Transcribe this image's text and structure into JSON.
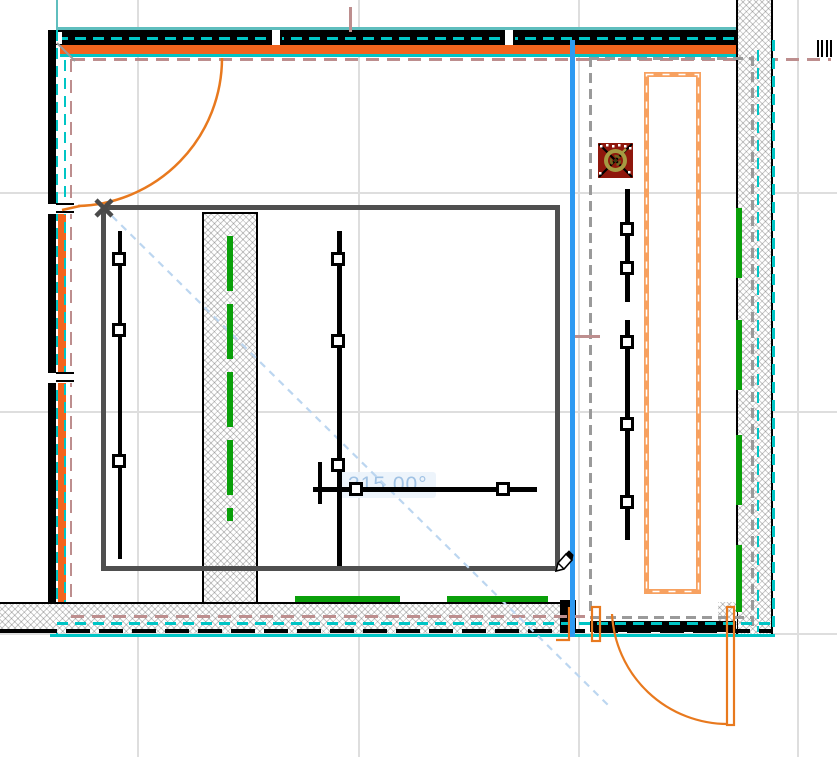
{
  "app": {
    "type": "cad-floor-plan-canvas",
    "tool": "pencil-draw"
  },
  "tooltip": {
    "text": "315.00°"
  },
  "colors": {
    "wall_orange": "#f3641d",
    "peach": "#f7a160",
    "door_orange": "#e8791e",
    "teal": "#5fbebe",
    "cyan": "#00c5c5",
    "brown": "#bd8e8e",
    "green": "#0aa00a",
    "blue": "#2e9af2",
    "light_blue": "#bcd6f0",
    "outline": "#4f4f4f",
    "grid": "#dedede",
    "gray_dash": "#9a9a9a",
    "red_symbol": "#8f170c",
    "gold": "#a59a42",
    "tooltip_text": "#a0c2e4",
    "tooltip_bg": "rgba(235,243,250,0.88)"
  },
  "grid": {
    "vlines": [
      137,
      358,
      578,
      797
    ],
    "hlines": [
      192,
      411,
      633
    ]
  },
  "electrical": {
    "vlines": [
      {
        "x": 117.5,
        "y1": 231,
        "y2": 559
      },
      {
        "x": 337,
        "y1": 231,
        "y2": 566
      },
      {
        "x": 625,
        "y1": 189,
        "y2": 302
      },
      {
        "x": 625,
        "y1": 320,
        "y2": 540
      },
      {
        "x": 317.5,
        "y1": 462,
        "y2": 504
      }
    ],
    "hlines": [
      {
        "y": 487,
        "x1": 313,
        "x2": 537
      }
    ],
    "line_width": 4.5,
    "nodes": [
      [
        112,
        252
      ],
      [
        112,
        323
      ],
      [
        112,
        454
      ],
      [
        331,
        252
      ],
      [
        331,
        334
      ],
      [
        331,
        458
      ],
      [
        349,
        482
      ],
      [
        496,
        482
      ],
      [
        620,
        222
      ],
      [
        620,
        261
      ],
      [
        620,
        335
      ],
      [
        620,
        417
      ],
      [
        620,
        495
      ]
    ]
  },
  "green_dashes": {
    "column": {
      "x": 227,
      "w": 6,
      "segments": [
        [
          236,
          291
        ],
        [
          304,
          359
        ],
        [
          372,
          427
        ],
        [
          440,
          495
        ],
        [
          508,
          521
        ]
      ]
    },
    "right_wall": {
      "x": 736,
      "w": 6,
      "segments": [
        [
          208,
          278
        ],
        [
          320,
          390
        ],
        [
          435,
          505
        ],
        [
          545,
          612
        ]
      ]
    },
    "bottom": {
      "y": 596,
      "h": 6,
      "segments": [
        [
          295,
          400
        ],
        [
          447,
          548
        ]
      ]
    }
  },
  "symbols": {
    "red_square": "ceiling-fixture-symbol",
    "x_marker": "draw-start-marker",
    "pencil": "pencil-cursor",
    "angle_readout": "angle-tooltip"
  }
}
